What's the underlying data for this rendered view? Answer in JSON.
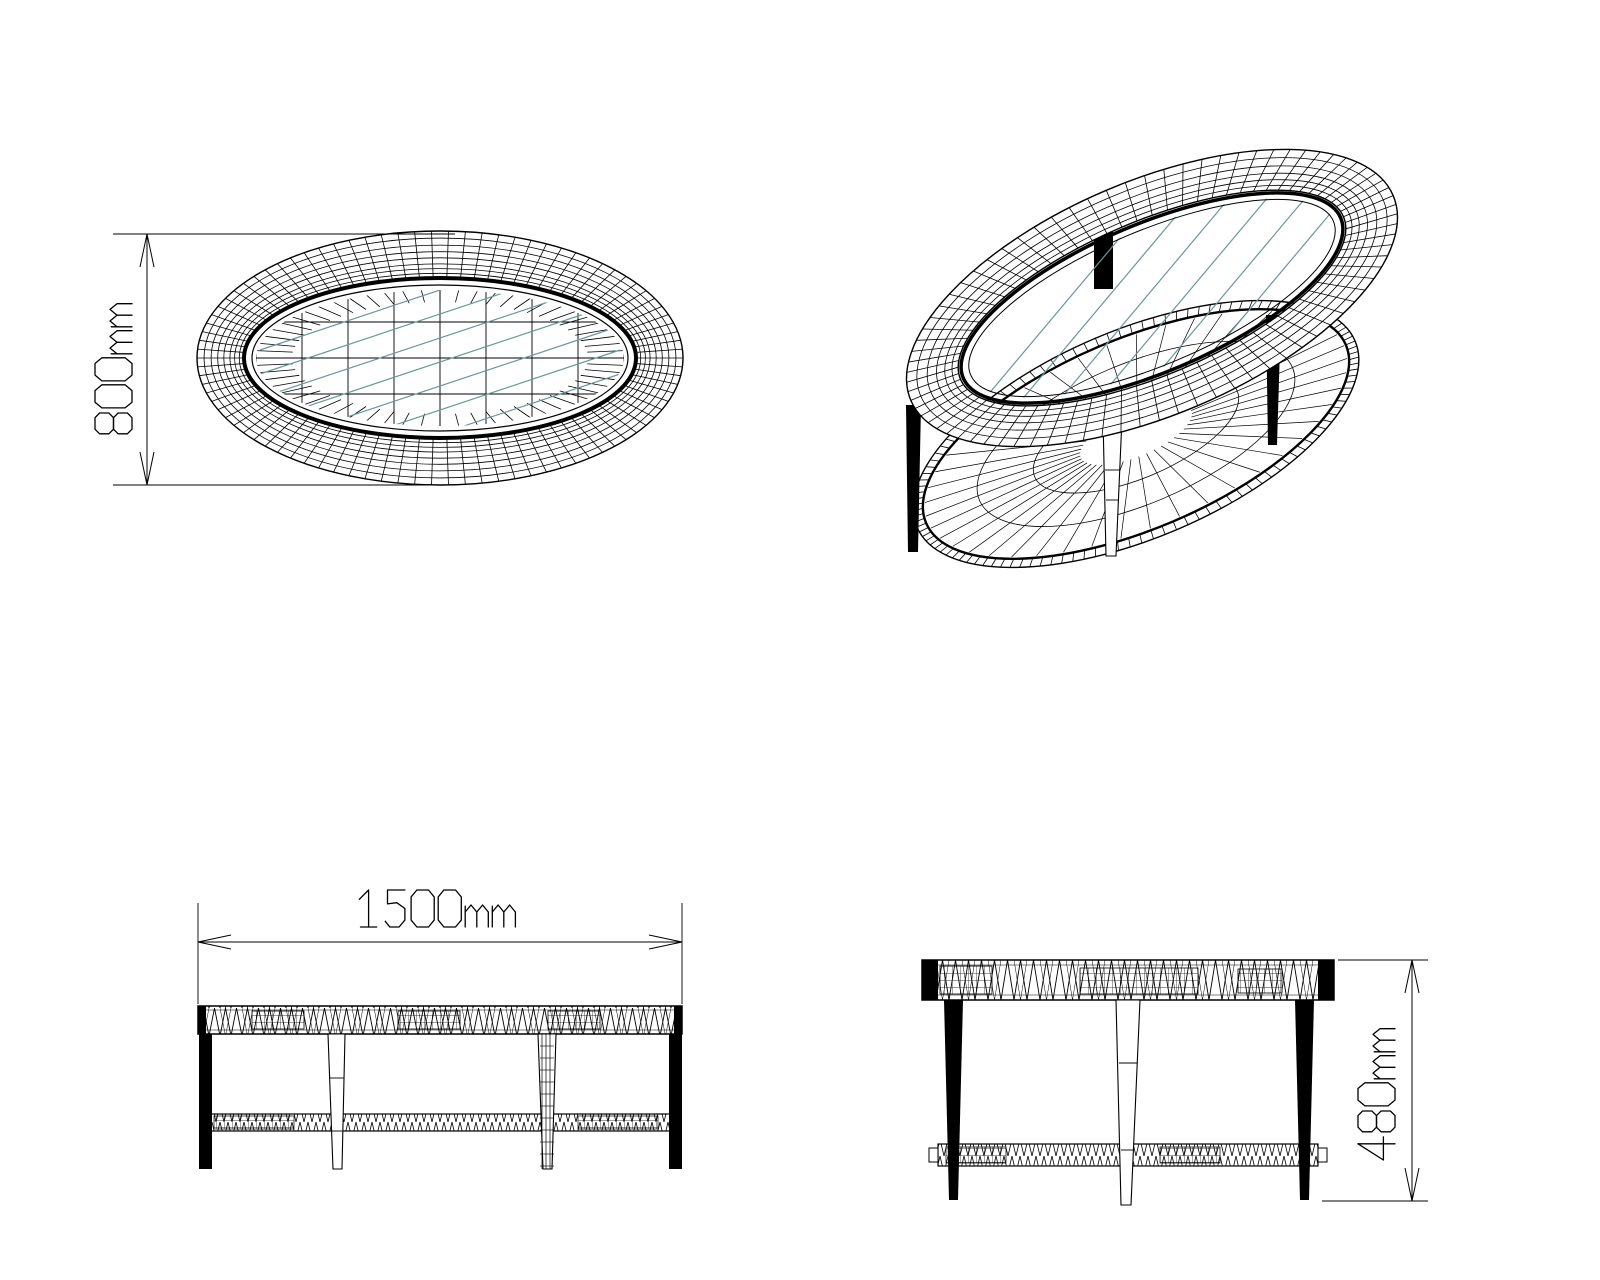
{
  "drawing": {
    "background": "#ffffff",
    "stroke_color": "#000000",
    "glass_reflection_color": "#68989a",
    "unit": "mm",
    "views": {
      "top": {
        "dimension_label": "800mm",
        "dimension_value": 800,
        "orientation": "vertical"
      },
      "isometric": {},
      "front": {
        "dimension_label": "1500mm",
        "dimension_value": 1500,
        "orientation": "horizontal"
      },
      "side": {
        "dimension_label": "480mm",
        "dimension_value": 480,
        "orientation": "vertical"
      }
    }
  }
}
